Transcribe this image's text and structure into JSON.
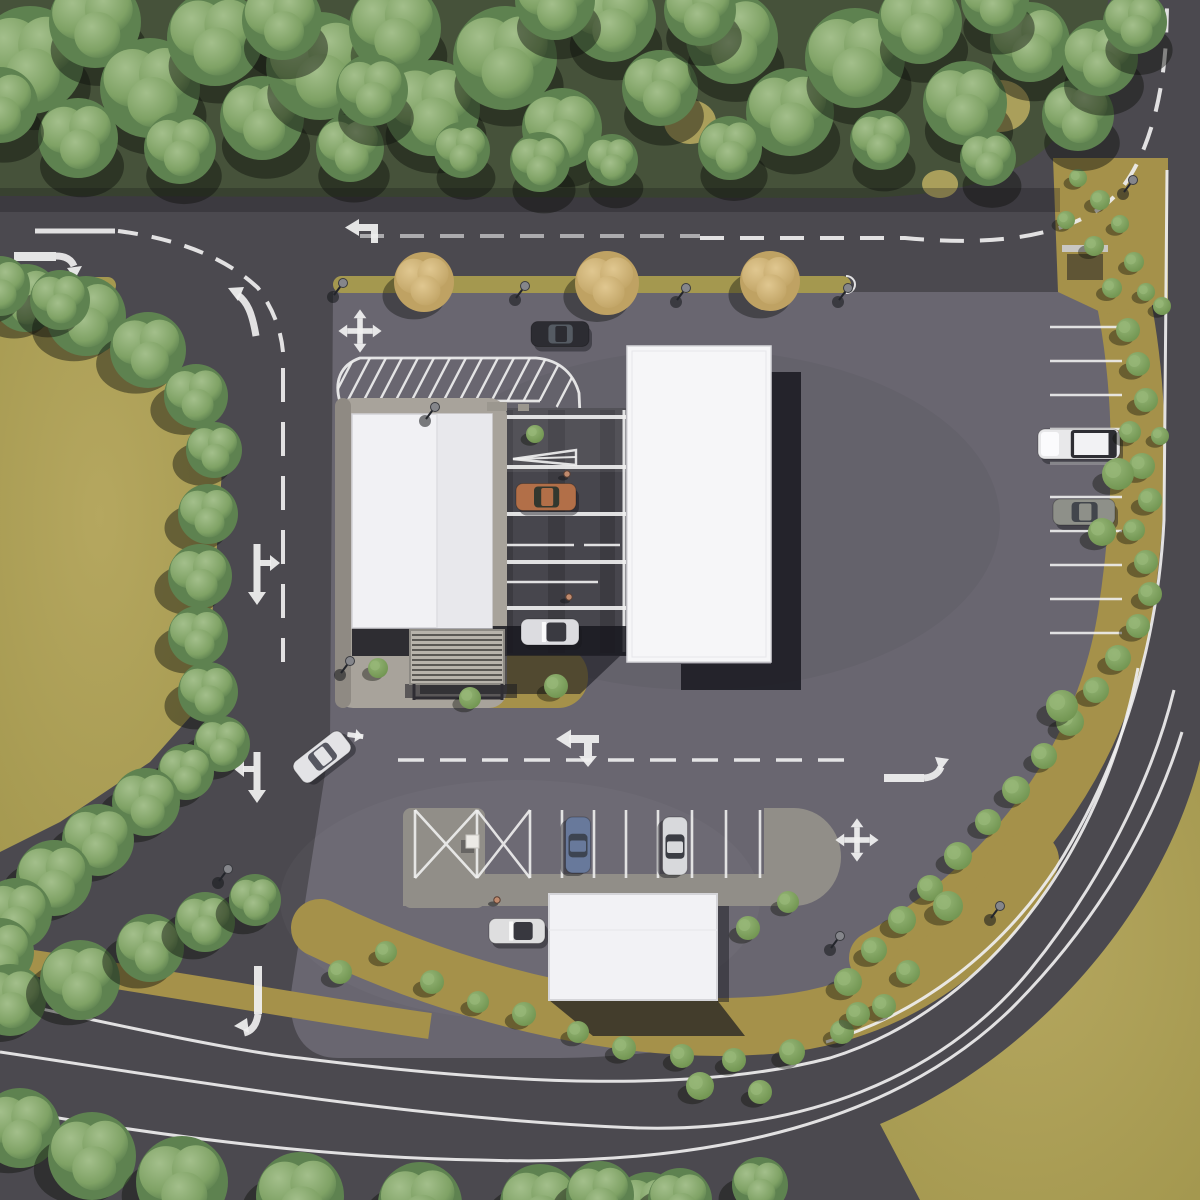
{
  "meta": {
    "title": "Aerial site plan rendering",
    "description": "Top-down 3D architectural visualization of a roadside service site: three white flat-roofed buildings, covered service lanes, parking rows, landscaped beds, perimeter roads with white pavement markings, and surrounding tree belts.",
    "view": "top-down aerial",
    "time_of_day": "daylight"
  },
  "palette": {
    "road": "#4b494f",
    "lot": "#696670",
    "lotlight": "#716e77",
    "field": "#a4984f",
    "fieldlight": "#b5a75f",
    "bed": "#a5914a",
    "forest": "#46523a",
    "treehi": "#a3bf8b",
    "treelo": "#7fa265",
    "treedk": "#5e8250",
    "autumnhi": "#e0c790",
    "autumnlo": "#bfa263",
    "bushhi": "#96b677",
    "bushlo": "#6f934f",
    "roofwest": "#f1f1f4",
    "roofwest2": "#e8e8ec",
    "roofeast": "#f6f6f8",
    "roofsouth": "#f2f2f5",
    "apron": "#a8a39b",
    "pathc": "#918e88",
    "pergola": "#b7b3ab",
    "lane": "#403f46",
    "white": "#efefef",
    "shadow": "#191920"
  },
  "buildings": [
    {
      "id": "west-building",
      "roof": [
        352,
        414,
        140,
        214
      ]
    },
    {
      "id": "east-building",
      "roof": [
        627,
        346,
        144,
        316
      ]
    },
    {
      "id": "south-building",
      "roof": [
        549,
        894,
        168,
        106
      ]
    },
    {
      "id": "pergola",
      "rect": [
        410,
        630,
        94,
        54
      ]
    }
  ],
  "vehicles": [
    {
      "id": "dark-sedan-main-road",
      "type": "sedan",
      "cx": 560,
      "cy": 334,
      "len": 58,
      "wid": 25,
      "angle": 0,
      "body": "#2c2c32",
      "glass": "#555b63"
    },
    {
      "id": "copper-coupe-lane",
      "type": "coupe",
      "cx": 546,
      "cy": 497,
      "len": 60,
      "wid": 27,
      "angle": 0,
      "body": "#b26f48",
      "glass": "#33382f"
    },
    {
      "id": "white-convertible-lane",
      "type": "convertible",
      "cx": 550,
      "cy": 632,
      "len": 58,
      "wid": 26,
      "angle": 0,
      "body": "#dcdce0",
      "glass": "#3a3a41"
    },
    {
      "id": "white-sedan-moving",
      "type": "sedan",
      "cx": 322,
      "cy": 757,
      "len": 60,
      "wid": 26,
      "angle": -38,
      "body": "#e3e3e6",
      "glass": "#565761"
    },
    {
      "id": "blue-car-parked",
      "type": "sedan",
      "cx": 578,
      "cy": 845,
      "len": 56,
      "wid": 25,
      "angle": 90,
      "body": "#68799b",
      "glass": "#3d4451"
    },
    {
      "id": "white-sedan-parked",
      "type": "sedan",
      "cx": 675,
      "cy": 846,
      "len": 58,
      "wid": 25,
      "angle": 90,
      "body": "#d8d9dc",
      "glass": "#3b3d44"
    },
    {
      "id": "white-convertible-south",
      "type": "convertible",
      "cx": 517,
      "cy": 931,
      "len": 56,
      "wid": 25,
      "angle": 0,
      "body": "#dededf",
      "glass": "#38383f"
    },
    {
      "id": "white-pickup-parked",
      "type": "pickup",
      "cx": 1079,
      "cy": 444,
      "len": 82,
      "wid": 30,
      "angle": 0,
      "body": "#e8e8ea",
      "glass": "#2e2e33"
    },
    {
      "id": "gray-sedan-parked",
      "type": "sedan",
      "cx": 1084,
      "cy": 512,
      "len": 62,
      "wid": 26,
      "angle": 0,
      "body": "#8e9089",
      "glass": "#42464c"
    }
  ],
  "vegetation": {
    "forest_top": [
      [
        30,
        60,
        54
      ],
      [
        95,
        22,
        46
      ],
      [
        150,
        88,
        50
      ],
      [
        215,
        38,
        48
      ],
      [
        262,
        118,
        42
      ],
      [
        320,
        66,
        54
      ],
      [
        395,
        28,
        46
      ],
      [
        432,
        108,
        48
      ],
      [
        505,
        58,
        52
      ],
      [
        562,
        128,
        40
      ],
      [
        612,
        18,
        44
      ],
      [
        660,
        88,
        38
      ],
      [
        732,
        38,
        46
      ],
      [
        790,
        112,
        44
      ],
      [
        855,
        58,
        50
      ],
      [
        920,
        22,
        42
      ],
      [
        965,
        103,
        42
      ],
      [
        1030,
        42,
        40
      ],
      [
        1078,
        115,
        36
      ],
      [
        1100,
        58,
        38
      ],
      [
        1135,
        22,
        32
      ],
      [
        78,
        138,
        40
      ],
      [
        180,
        148,
        36
      ],
      [
        350,
        148,
        34
      ],
      [
        540,
        162,
        30
      ],
      [
        730,
        148,
        32
      ],
      [
        988,
        158,
        28
      ],
      [
        0,
        105,
        38
      ],
      [
        612,
        160,
        26
      ],
      [
        462,
        150,
        28
      ],
      [
        880,
        140,
        30
      ],
      [
        282,
        20,
        40
      ],
      [
        700,
        10,
        36
      ],
      [
        995,
        0,
        34
      ],
      [
        555,
        0,
        40
      ],
      [
        372,
        90,
        36
      ]
    ],
    "field_trees": [
      [
        26,
        298,
        34
      ],
      [
        86,
        316,
        40
      ],
      [
        148,
        350,
        38
      ],
      [
        196,
        396,
        32
      ],
      [
        214,
        450,
        28
      ],
      [
        208,
        514,
        30
      ],
      [
        200,
        576,
        32
      ],
      [
        198,
        636,
        30
      ],
      [
        208,
        692,
        30
      ],
      [
        222,
        744,
        28
      ],
      [
        186,
        772,
        28
      ],
      [
        146,
        802,
        34
      ],
      [
        98,
        840,
        36
      ],
      [
        54,
        878,
        38
      ],
      [
        16,
        914,
        36
      ],
      [
        0,
        952,
        34
      ],
      [
        60,
        300,
        30
      ],
      [
        0,
        286,
        30
      ]
    ],
    "bottom_trees": [
      [
        10,
        1000,
        36
      ],
      [
        80,
        980,
        40
      ],
      [
        150,
        948,
        34
      ],
      [
        205,
        922,
        30
      ],
      [
        255,
        900,
        26
      ],
      [
        20,
        1128,
        40
      ],
      [
        92,
        1156,
        44
      ],
      [
        182,
        1182,
        46
      ],
      [
        300,
        1196,
        44
      ],
      [
        420,
        1204,
        42
      ],
      [
        540,
        1204,
        40
      ],
      [
        648,
        1208,
        36
      ],
      [
        600,
        1195,
        34
      ],
      [
        680,
        1200,
        32
      ],
      [
        760,
        1185,
        28
      ]
    ],
    "median_trees": [
      [
        424,
        282,
        30
      ],
      [
        607,
        283,
        32
      ],
      [
        770,
        281,
        30
      ]
    ],
    "island_bushes": [
      [
        1078,
        178,
        9
      ],
      [
        1100,
        200,
        10
      ],
      [
        1066,
        220,
        9
      ],
      [
        1094,
        246,
        10
      ],
      [
        1120,
        224,
        9
      ],
      [
        1134,
        262,
        10
      ],
      [
        1112,
        288,
        10
      ],
      [
        1146,
        292,
        9
      ]
    ],
    "strip_bushes": [
      [
        1128,
        330,
        12
      ],
      [
        1138,
        364,
        12
      ],
      [
        1146,
        400,
        12
      ],
      [
        1130,
        432,
        11
      ],
      [
        1142,
        466,
        13
      ],
      [
        1150,
        500,
        12
      ],
      [
        1134,
        530,
        11
      ],
      [
        1146,
        562,
        12
      ],
      [
        1150,
        594,
        12
      ],
      [
        1138,
        626,
        12
      ],
      [
        1118,
        658,
        13
      ],
      [
        1096,
        690,
        13
      ],
      [
        1070,
        722,
        14
      ],
      [
        1044,
        756,
        13
      ],
      [
        1016,
        790,
        14
      ],
      [
        988,
        822,
        13
      ],
      [
        958,
        856,
        14
      ],
      [
        930,
        888,
        13
      ],
      [
        902,
        920,
        14
      ],
      [
        874,
        950,
        13
      ],
      [
        848,
        982,
        14
      ],
      [
        858,
        1014,
        12
      ],
      [
        1162,
        306,
        9
      ],
      [
        1160,
        436,
        9
      ],
      [
        1118,
        474,
        16
      ],
      [
        1102,
        532,
        14
      ],
      [
        1062,
        706,
        16
      ],
      [
        948,
        906,
        15
      ]
    ],
    "bed_bushes": [
      [
        378,
        668,
        10
      ],
      [
        470,
        698,
        11
      ],
      [
        556,
        686,
        12
      ],
      [
        340,
        972,
        12
      ],
      [
        386,
        952,
        11
      ],
      [
        432,
        982,
        12
      ],
      [
        478,
        1002,
        11
      ],
      [
        524,
        1014,
        12
      ],
      [
        578,
        1032,
        11
      ],
      [
        624,
        1048,
        12
      ],
      [
        682,
        1056,
        12
      ],
      [
        734,
        1060,
        12
      ],
      [
        792,
        1052,
        13
      ],
      [
        842,
        1032,
        12
      ],
      [
        884,
        1006,
        12
      ],
      [
        748,
        928,
        12
      ],
      [
        788,
        902,
        11
      ],
      [
        700,
        1086,
        14
      ],
      [
        760,
        1092,
        12
      ],
      [
        908,
        972,
        12
      ],
      [
        535,
        434,
        9
      ]
    ]
  },
  "light_poles": [
    [
      343,
      283
    ],
    [
      525,
      286
    ],
    [
      686,
      288
    ],
    [
      848,
      288
    ],
    [
      98,
      285
    ],
    [
      435,
      407
    ],
    [
      350,
      661
    ],
    [
      228,
      869
    ],
    [
      250,
      889
    ],
    [
      1133,
      180
    ],
    [
      1000,
      906
    ],
    [
      840,
      936
    ]
  ],
  "people": [
    [
      567,
      474
    ],
    [
      569,
      597
    ],
    [
      497,
      900
    ]
  ],
  "parking": {
    "bottom_row": {
      "stall_x": [
        415,
        477,
        530,
        562,
        594,
        626,
        658,
        692,
        726,
        760
      ],
      "y1": 810,
      "y2": 878,
      "crossed_cells": [
        0,
        1
      ]
    },
    "right_column": {
      "stripe_y": [
        327,
        361,
        395,
        429,
        463,
        497,
        531,
        565,
        599,
        633
      ],
      "x1": 1050,
      "x2": 1122
    }
  },
  "markings": [
    {
      "type": "right-turn-arrow",
      "area": "west entrance"
    },
    {
      "type": "left-and-straight-arrow",
      "area": "main road eastbound"
    },
    {
      "type": "four-way-arrow",
      "area": "main lot north"
    },
    {
      "type": "four-way-arrow",
      "area": "lot south-east"
    },
    {
      "type": "merge-hook-arrow",
      "area": "entrance curve"
    },
    {
      "type": "down-and-right-arrow",
      "area": "west internal road"
    },
    {
      "type": "down-and-left-arrow",
      "area": "west internal road south"
    },
    {
      "type": "turn-left-end-arrow",
      "area": "west internal road exit"
    },
    {
      "type": "left-and-down-arrow",
      "area": "south aisle"
    },
    {
      "type": "right-turn-arrow",
      "area": "south aisle east"
    },
    {
      "type": "give-way-wedge",
      "area": "canopy lane 1"
    },
    {
      "type": "crosshatch-keep-clear",
      "area": "north of west building"
    },
    {
      "type": "dashed-lane-lines",
      "area": "main road, internal roads, right road"
    },
    {
      "type": "solid-edge-lines",
      "area": "perimeter roads"
    }
  ]
}
